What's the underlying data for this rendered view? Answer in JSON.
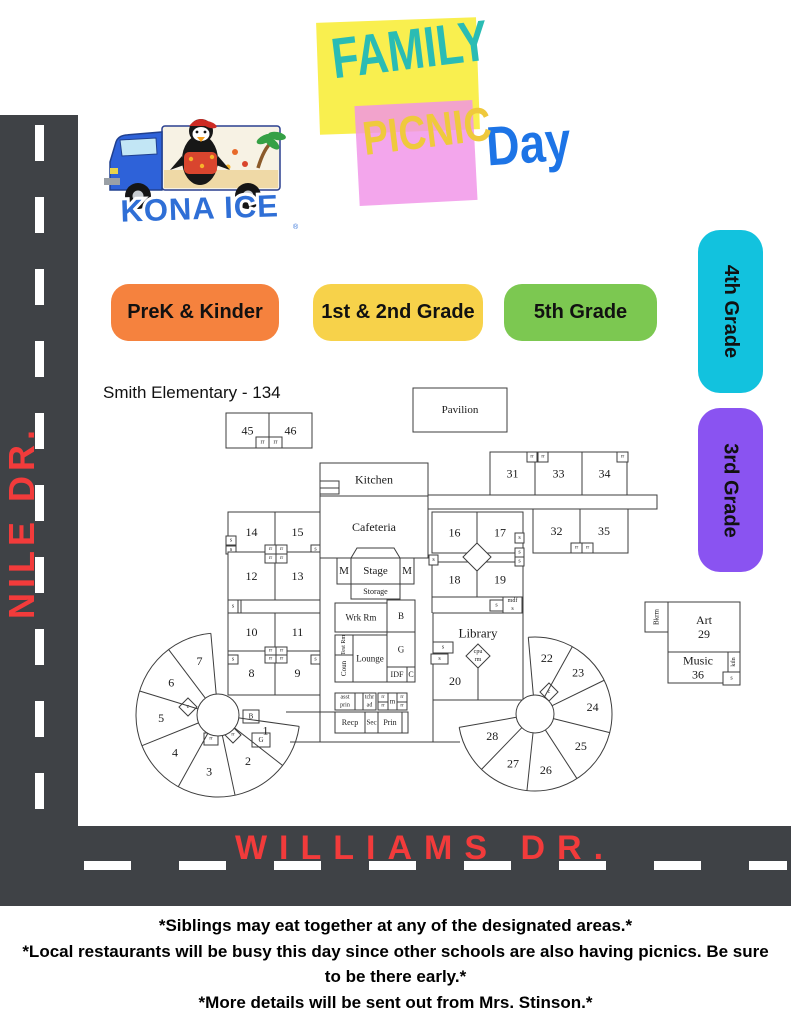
{
  "title": {
    "family": "FAMILY",
    "picnic": "PICNIC",
    "day": "Day"
  },
  "logo": {
    "brand": "KONA ICE",
    "reg": "®"
  },
  "legend": [
    {
      "label": "PreK & Kinder",
      "color": "#F5823E"
    },
    {
      "label": "1st & 2nd Grade",
      "color": "#F7D24A"
    },
    {
      "label": "5th Grade",
      "color": "#7CC851"
    },
    {
      "label": "4th Grade",
      "color": "#12C2DE"
    },
    {
      "label": "3rd Grade",
      "color": "#8A53F1"
    }
  ],
  "roads": {
    "left_name": "NILE DR.",
    "bottom_name": "WILLIAMS DR."
  },
  "notes": [
    "*Siblings may eat together at any of the designated areas.*",
    "*Local restaurants will be busy this day since other schools are also having picnics. Be sure to be there early.*",
    "*More details will be sent out from Mrs. Stinson.*"
  ],
  "palette": {
    "road": "#3F4246",
    "road_dash": "#FFFFFF",
    "road_text": "#F23B3B",
    "family_box": "#F9EF4F",
    "family_text": "#2ABCB4",
    "picnic_box": "#F092E8",
    "picnic_text": "#EFC93C",
    "day_text": "#1D74E6",
    "prek": "#F5823E",
    "grade12": "#F7D24A",
    "grade5": "#7CC851",
    "grade4": "#12C2DE",
    "grade3": "#8A53F1",
    "map_line": "#3D3D3D"
  },
  "map": {
    "title": "Smith Elementary - 134",
    "rooms": [
      {
        "x": 226,
        "y": 413,
        "w": 43,
        "h": 35,
        "l": "45"
      },
      {
        "x": 269,
        "y": 413,
        "w": 43,
        "h": 35,
        "l": "46"
      },
      {
        "x": 256,
        "y": 437,
        "w": 13,
        "h": 11,
        "l": "rr",
        "fs": 6
      },
      {
        "x": 269,
        "y": 437,
        "w": 13,
        "h": 11,
        "l": "rr",
        "fs": 6
      },
      {
        "x": 413,
        "y": 388,
        "w": 94,
        "h": 44,
        "l": "Pavilion",
        "fs": 11
      },
      {
        "x": 320,
        "y": 463,
        "w": 108,
        "h": 33,
        "l": "Kitchen",
        "fs": 12
      },
      {
        "x": 320,
        "y": 481,
        "w": 19,
        "h": 7
      },
      {
        "x": 320,
        "y": 488,
        "w": 19,
        "h": 6
      },
      {
        "x": 320,
        "y": 496,
        "w": 108,
        "h": 62,
        "l": "Cafeteria",
        "fs": 12
      },
      {
        "x": 337,
        "y": 558,
        "w": 14,
        "h": 26,
        "l": "M",
        "fs": 11
      },
      {
        "x": 351,
        "y": 558,
        "w": 49,
        "h": 26,
        "l": "Stage",
        "fs": 11
      },
      {
        "x": 400,
        "y": 558,
        "w": 14,
        "h": 26,
        "l": "M",
        "fs": 11
      },
      {
        "x": 351,
        "y": 584,
        "w": 49,
        "h": 15,
        "l": "Storage",
        "fs": 8
      },
      {
        "x": 228,
        "y": 512,
        "w": 47,
        "h": 40,
        "l": "14"
      },
      {
        "x": 275,
        "y": 512,
        "w": 45,
        "h": 40,
        "l": "15"
      },
      {
        "x": 226,
        "y": 536,
        "w": 10,
        "h": 9,
        "l": "s",
        "fs": 6
      },
      {
        "x": 226,
        "y": 546,
        "w": 10,
        "h": 8,
        "l": "s",
        "fs": 6
      },
      {
        "x": 311,
        "y": 545,
        "w": 9,
        "h": 9,
        "l": "s",
        "fs": 6
      },
      {
        "x": 228,
        "y": 552,
        "w": 47,
        "h": 48,
        "l": "12"
      },
      {
        "x": 275,
        "y": 552,
        "w": 45,
        "h": 48,
        "l": "13"
      },
      {
        "x": 265,
        "y": 545,
        "w": 11,
        "h": 9,
        "l": "rr",
        "fs": 5
      },
      {
        "x": 276,
        "y": 545,
        "w": 11,
        "h": 9,
        "l": "rr",
        "fs": 5
      },
      {
        "x": 265,
        "y": 554,
        "w": 11,
        "h": 9,
        "l": "rr",
        "fs": 5
      },
      {
        "x": 276,
        "y": 554,
        "w": 11,
        "h": 9,
        "l": "rr",
        "fs": 5
      },
      {
        "x": 228,
        "y": 600,
        "w": 92,
        "h": 13
      },
      {
        "x": 228,
        "y": 600,
        "w": 10,
        "h": 13,
        "l": "s",
        "fs": 6
      },
      {
        "x": 228,
        "y": 613,
        "w": 47,
        "h": 38,
        "l": "10"
      },
      {
        "x": 275,
        "y": 613,
        "w": 45,
        "h": 38,
        "l": "11"
      },
      {
        "x": 228,
        "y": 651,
        "w": 47,
        "h": 44,
        "l": "8"
      },
      {
        "x": 275,
        "y": 651,
        "w": 45,
        "h": 44,
        "l": "9"
      },
      {
        "x": 265,
        "y": 647,
        "w": 11,
        "h": 8,
        "l": "rr",
        "fs": 5
      },
      {
        "x": 276,
        "y": 647,
        "w": 11,
        "h": 8,
        "l": "rr",
        "fs": 5
      },
      {
        "x": 265,
        "y": 655,
        "w": 11,
        "h": 8,
        "l": "rr",
        "fs": 5
      },
      {
        "x": 276,
        "y": 655,
        "w": 11,
        "h": 8,
        "l": "rr",
        "fs": 5
      },
      {
        "x": 228,
        "y": 655,
        "w": 10,
        "h": 9,
        "l": "s",
        "fs": 6
      },
      {
        "x": 311,
        "y": 655,
        "w": 9,
        "h": 9,
        "l": "s",
        "fs": 6
      },
      {
        "x": 335,
        "y": 603,
        "w": 52,
        "h": 29,
        "l": "Wrk Rm",
        "fs": 9
      },
      {
        "x": 387,
        "y": 600,
        "w": 28,
        "h": 32,
        "l": "B",
        "fs": 9
      },
      {
        "x": 335,
        "y": 635,
        "w": 18,
        "h": 20,
        "l": "Test Rm",
        "fs": 6,
        "vert": true
      },
      {
        "x": 335,
        "y": 655,
        "w": 18,
        "h": 27,
        "l": "Coun",
        "fs": 7,
        "vert": true
      },
      {
        "x": 353,
        "y": 635,
        "w": 34,
        "h": 47,
        "l": "Lounge",
        "fs": 9
      },
      {
        "x": 387,
        "y": 632,
        "w": 28,
        "h": 35,
        "l": "G",
        "fs": 9
      },
      {
        "x": 387,
        "y": 667,
        "w": 20,
        "h": 15,
        "l": "IDF",
        "fs": 8
      },
      {
        "x": 407,
        "y": 667,
        "w": 8,
        "h": 15,
        "l": "C",
        "fs": 8
      },
      {
        "x": 335,
        "y": 693,
        "w": 20,
        "h": 17,
        "l": "asst prin",
        "fs": 6,
        "two": true
      },
      {
        "x": 355,
        "y": 693,
        "w": 8,
        "h": 17
      },
      {
        "x": 363,
        "y": 693,
        "w": 13,
        "h": 17,
        "l": "tchr ad",
        "fs": 6,
        "two": true
      },
      {
        "x": 378,
        "y": 693,
        "w": 10,
        "h": 9,
        "l": "rr",
        "fs": 5
      },
      {
        "x": 378,
        "y": 702,
        "w": 10,
        "h": 8,
        "l": "rr",
        "fs": 5
      },
      {
        "x": 388,
        "y": 693,
        "w": 9,
        "h": 17,
        "l": "m",
        "fs": 7
      },
      {
        "x": 397,
        "y": 693,
        "w": 10,
        "h": 9,
        "l": "rr",
        "fs": 5
      },
      {
        "x": 397,
        "y": 702,
        "w": 10,
        "h": 8,
        "l": "rr",
        "fs": 5
      },
      {
        "x": 335,
        "y": 712,
        "w": 30,
        "h": 21,
        "l": "Recp",
        "fs": 8
      },
      {
        "x": 365,
        "y": 712,
        "w": 13,
        "h": 21,
        "l": "Sec",
        "fs": 7
      },
      {
        "x": 378,
        "y": 712,
        "w": 24,
        "h": 21,
        "l": "Prin",
        "fs": 8
      },
      {
        "x": 402,
        "y": 712,
        "w": 6,
        "h": 21
      },
      {
        "x": 432,
        "y": 512,
        "w": 45,
        "h": 41,
        "l": "16"
      },
      {
        "x": 477,
        "y": 512,
        "w": 46,
        "h": 41,
        "l": "17"
      },
      {
        "x": 432,
        "y": 562,
        "w": 45,
        "h": 35,
        "l": "18"
      },
      {
        "x": 477,
        "y": 562,
        "w": 46,
        "h": 35,
        "l": "19"
      },
      {
        "x": 515,
        "y": 533,
        "w": 9,
        "h": 10,
        "l": "s",
        "fs": 6
      },
      {
        "x": 515,
        "y": 548,
        "w": 9,
        "h": 9,
        "l": "s",
        "fs": 6
      },
      {
        "x": 515,
        "y": 557,
        "w": 9,
        "h": 9,
        "l": "s",
        "fs": 6
      },
      {
        "x": 429,
        "y": 555,
        "w": 9,
        "h": 10,
        "l": "s",
        "fs": 6
      },
      {
        "x": 490,
        "y": 600,
        "w": 13,
        "h": 11,
        "l": "s",
        "fs": 6
      },
      {
        "x": 503,
        "y": 597,
        "w": 19,
        "h": 16,
        "l": "mdf",
        "l2": "s",
        "fs": 6
      },
      {
        "x": 433,
        "y": 613,
        "w": 90,
        "h": 87
      },
      {
        "x": 433,
        "y": 642,
        "w": 20,
        "h": 11,
        "l": "s",
        "fs": 6
      },
      {
        "x": 431,
        "y": 654,
        "w": 17,
        "h": 10,
        "l": "s",
        "fs": 6
      },
      {
        "x": 428,
        "y": 495,
        "w": 229,
        "h": 14
      },
      {
        "x": 490,
        "y": 452,
        "w": 45,
        "h": 43,
        "l": "31"
      },
      {
        "x": 535,
        "y": 452,
        "w": 47,
        "h": 43,
        "l": "33"
      },
      {
        "x": 582,
        "y": 452,
        "w": 45,
        "h": 43,
        "l": "34"
      },
      {
        "x": 527,
        "y": 452,
        "w": 10,
        "h": 10,
        "l": "rr",
        "fs": 5
      },
      {
        "x": 538,
        "y": 452,
        "w": 10,
        "h": 10,
        "l": "rr",
        "fs": 5
      },
      {
        "x": 617,
        "y": 452,
        "w": 11,
        "h": 10,
        "l": "rr",
        "fs": 5
      },
      {
        "x": 533,
        "y": 509,
        "w": 47,
        "h": 44,
        "l": "32"
      },
      {
        "x": 580,
        "y": 509,
        "w": 48,
        "h": 44,
        "l": "35"
      },
      {
        "x": 571,
        "y": 543,
        "w": 11,
        "h": 10,
        "l": "rr",
        "fs": 5
      },
      {
        "x": 582,
        "y": 543,
        "w": 11,
        "h": 10,
        "l": "rr",
        "fs": 5
      },
      {
        "x": 645,
        "y": 602,
        "w": 23,
        "h": 30,
        "l": "Bkrm",
        "fs": 7,
        "vert": true
      },
      {
        "x": 668,
        "y": 602,
        "w": 72,
        "h": 50,
        "l": "Art",
        "l2": "29",
        "fs": 12
      },
      {
        "x": 668,
        "y": 652,
        "w": 60,
        "h": 31,
        "l": "Music",
        "l2": "36",
        "fs": 12
      },
      {
        "x": 728,
        "y": 652,
        "w": 12,
        "h": 20,
        "l": "kiln",
        "fs": 6,
        "vert": true
      },
      {
        "x": 723,
        "y": 672,
        "w": 17,
        "h": 13,
        "l": "s",
        "fs": 6
      },
      {
        "x": 243,
        "y": 710,
        "w": 16,
        "h": 13,
        "l": "B",
        "fs": 7
      },
      {
        "x": 252,
        "y": 733,
        "w": 18,
        "h": 14,
        "l": "G",
        "fs": 7
      },
      {
        "x": 204,
        "y": 733,
        "w": 14,
        "h": 12,
        "l": "rr",
        "fs": 5
      }
    ],
    "texts": [
      {
        "x": 478,
        "y": 633,
        "t": "Library",
        "fs": 13
      },
      {
        "x": 455,
        "y": 681,
        "t": "20",
        "fs": 12
      }
    ],
    "lines": [
      [
        320,
        497,
        320,
        742
      ],
      [
        433,
        700,
        433,
        742
      ],
      [
        290,
        742,
        460,
        742
      ],
      [
        286,
        712,
        335,
        712
      ],
      [
        478,
        668,
        478,
        700
      ],
      [
        241,
        600,
        241,
        613
      ],
      [
        523,
        597,
        523,
        613
      ],
      [
        432,
        597,
        432,
        613
      ]
    ],
    "paths": [
      "M351,558 L357,548 L394,548 L400,558"
    ],
    "diamonds": [
      {
        "cx": 477,
        "cy": 557,
        "r": 14
      },
      {
        "cx": 478,
        "cy": 656,
        "r": 12,
        "l": "cpu",
        "l2": "rm",
        "fs": 6
      },
      {
        "cx": 188,
        "cy": 707,
        "r": 9,
        "l": "c",
        "fs": 6
      },
      {
        "cx": 233,
        "cy": 735,
        "r": 8,
        "l": "rr",
        "fs": 5
      },
      {
        "cx": 549,
        "cy": 692,
        "r": 9,
        "l": "c",
        "fs": 6
      }
    ],
    "pods": [
      {
        "cx": 218,
        "cy": 715,
        "rO": 82,
        "rH": 21,
        "a0": -95,
        "a1": 8,
        "sweep": 0,
        "spokes": [
          -95,
          -127,
          -163,
          158,
          119,
          78,
          38,
          8
        ],
        "labels": [
          {
            "t": "7",
            "a": -109,
            "r": 57
          },
          {
            "t": "6",
            "a": -145,
            "r": 57
          },
          {
            "t": "5",
            "a": 177,
            "r": 57
          },
          {
            "t": "4",
            "a": 139,
            "r": 57
          },
          {
            "t": "3",
            "a": 99,
            "r": 57
          },
          {
            "t": "2",
            "a": 57,
            "r": 55
          },
          {
            "t": "1",
            "a": 18,
            "r": 50
          }
        ]
      },
      {
        "cx": 535,
        "cy": 714,
        "rO": 77,
        "rH": 19,
        "a0": -95,
        "a1": 170,
        "sweep": 1,
        "spokes": [
          -95,
          -61,
          -26,
          14,
          57,
          96,
          134,
          170
        ],
        "labels": [
          {
            "t": "22",
            "a": -78,
            "r": 57
          },
          {
            "t": "23",
            "a": -44,
            "r": 60
          },
          {
            "t": "24",
            "a": -7,
            "r": 58
          },
          {
            "t": "25",
            "a": 35,
            "r": 56
          },
          {
            "t": "26",
            "a": 79,
            "r": 57
          },
          {
            "t": "27",
            "a": 114,
            "r": 54
          },
          {
            "t": "28",
            "a": 153,
            "r": 48
          }
        ]
      }
    ]
  }
}
